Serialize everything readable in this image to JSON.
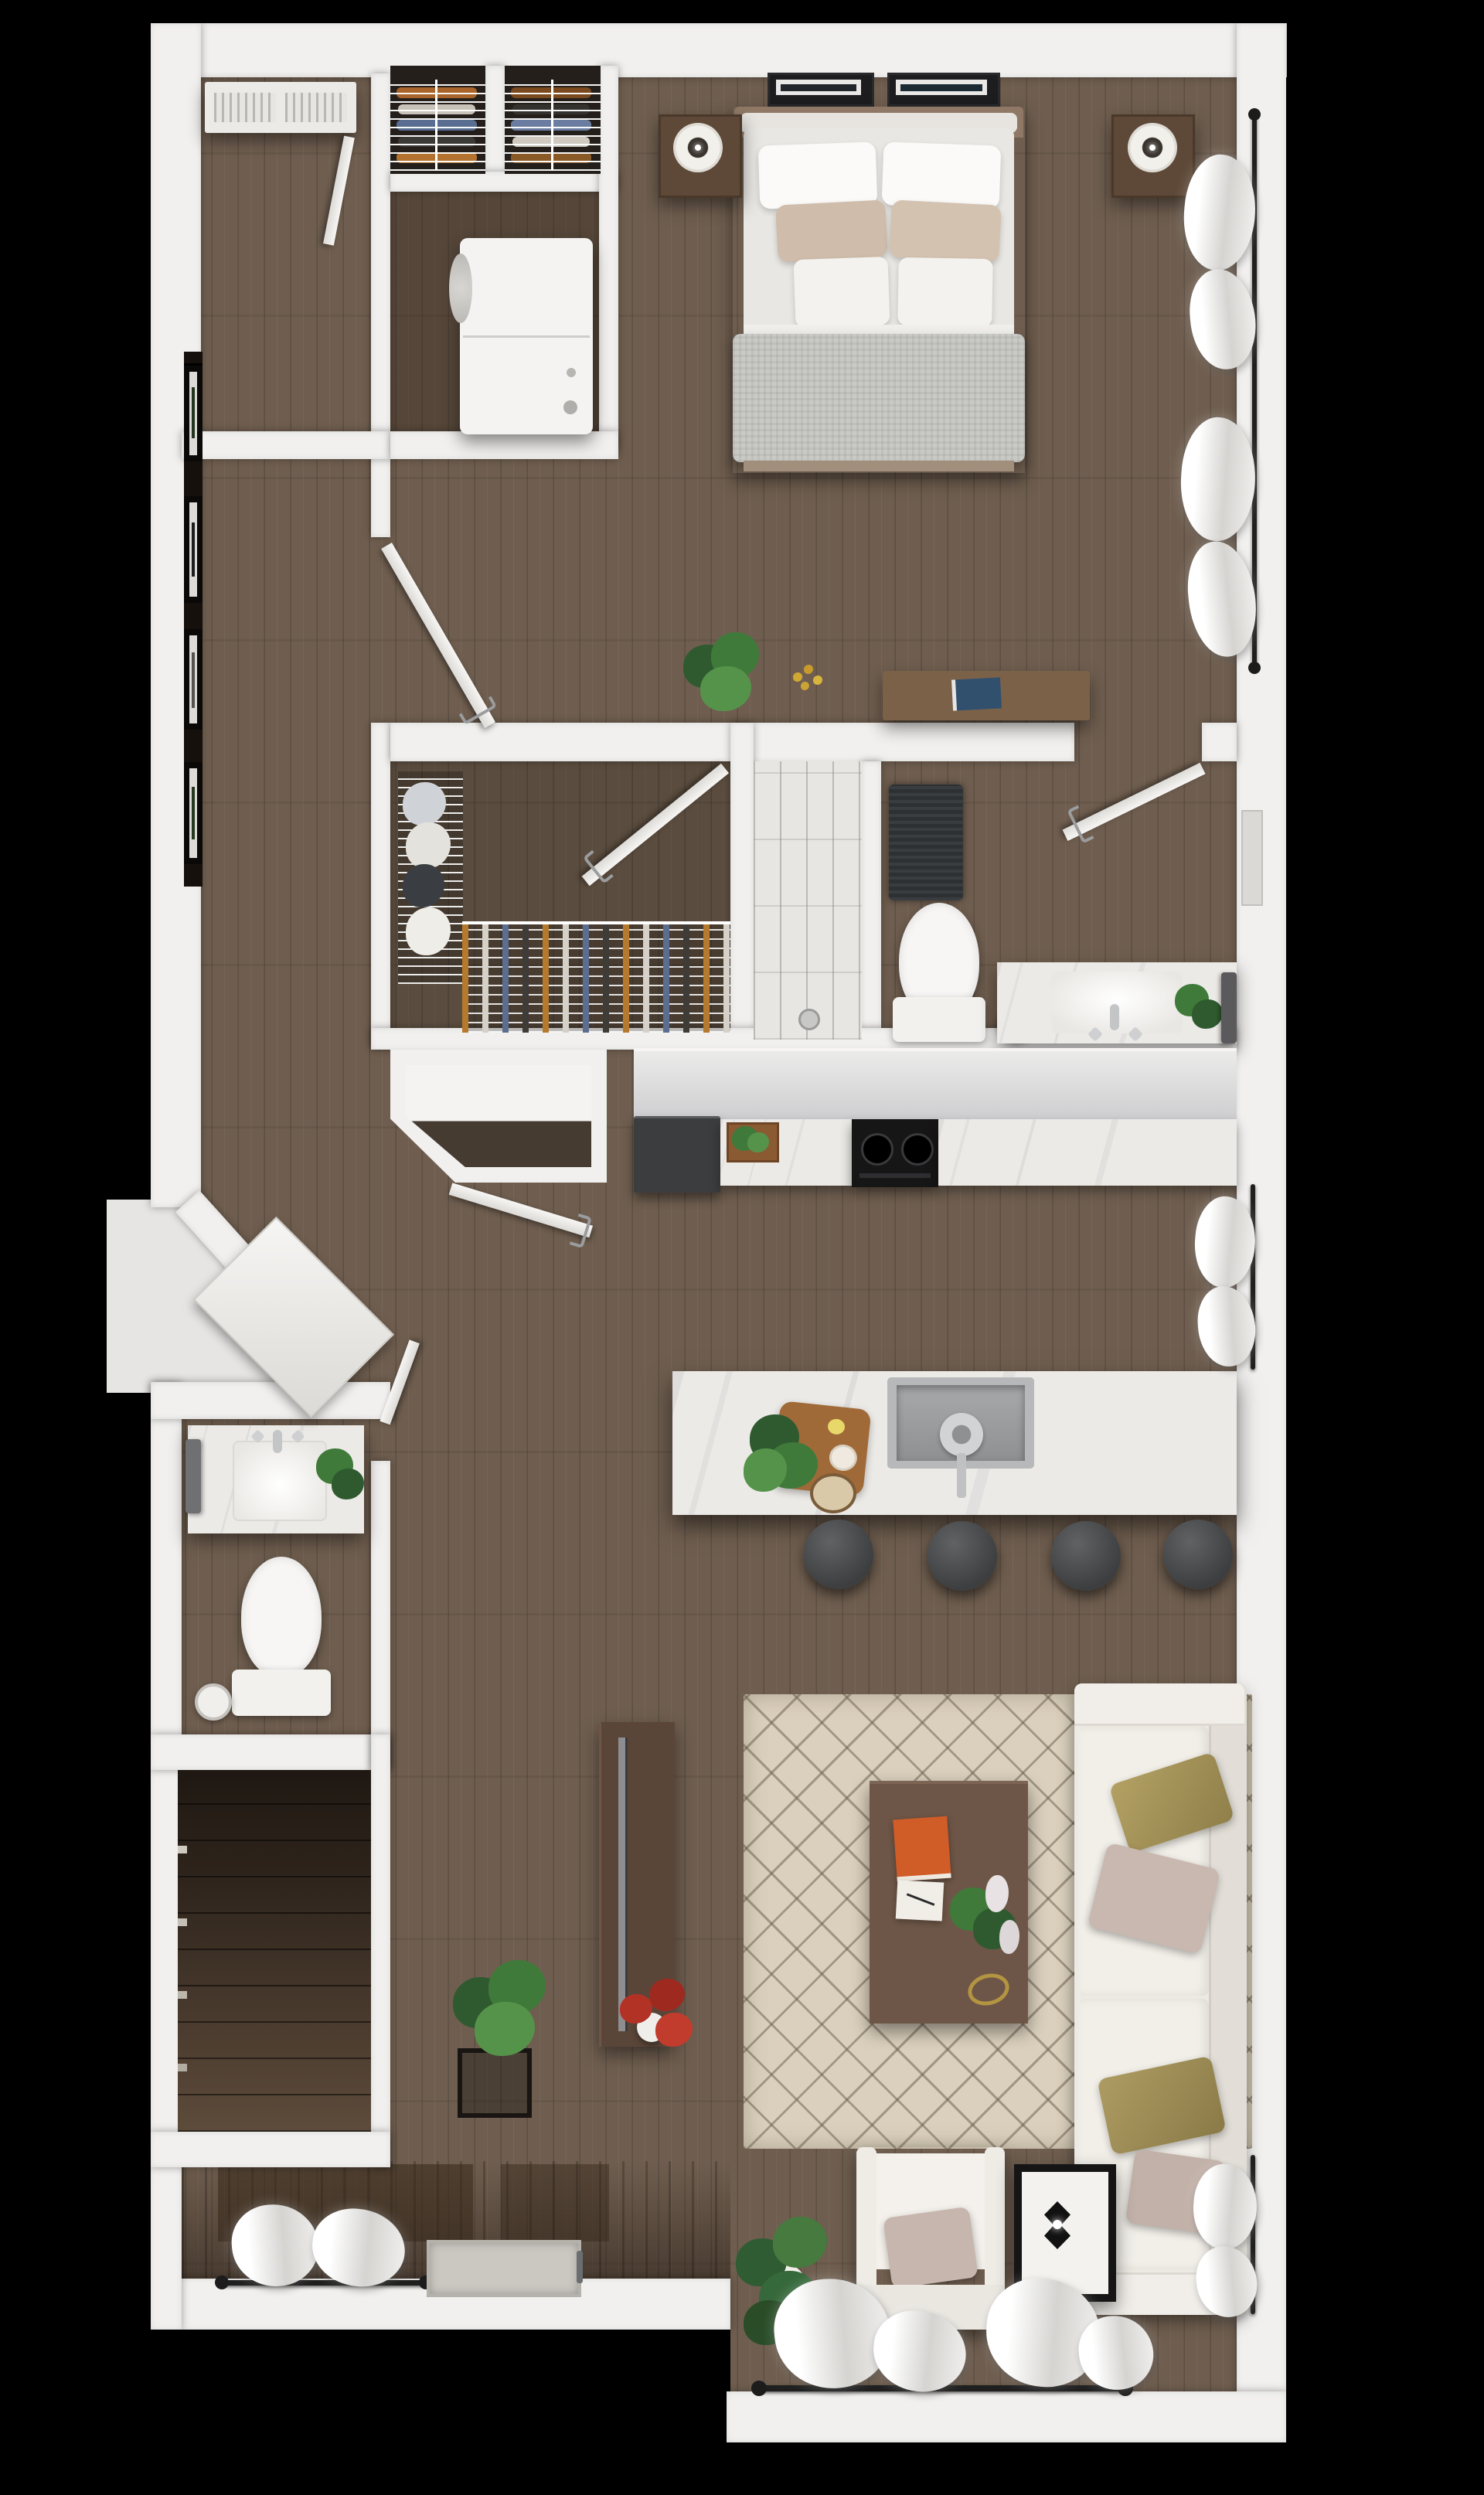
{
  "scene": {
    "description": "3D rendered top-down dollhouse floor plan of a one-bedroom apartment",
    "view": "top-down",
    "background_color": "#000000"
  },
  "rooms": {
    "bedroom": {
      "name": "Bedroom",
      "furniture": [
        "king bed with white bedding",
        "two white sleeping pillows",
        "two beige accent pillows",
        "two white front pillows",
        "gray knit throw blanket",
        "left nightstand",
        "right nightstand",
        "round table lamp left",
        "round table lamp right",
        "framed artwork pair above headboard",
        "wood media bench",
        "blue book",
        "green potted plant",
        "yellow flowers",
        "window with sheer curtains"
      ]
    },
    "closet_a": {
      "name": "Closet",
      "furniture": [
        "wire shelving",
        "folded clothes"
      ]
    },
    "closet_b": {
      "name": "Closet",
      "furniture": [
        "wire shelving",
        "folded clothes"
      ]
    },
    "laundry": {
      "name": "Laundry Closet",
      "furniture": [
        "stacked washer and dryer"
      ]
    },
    "utility": {
      "name": "Utility Room",
      "furniture": [
        "ceiling HVAC unit with louvers",
        "door"
      ]
    },
    "hallway": {
      "name": "Hallway",
      "furniture": [
        "gallery wall with four dark picture frames"
      ]
    },
    "walk_in_closet": {
      "name": "Walk-in Closet",
      "furniture": [
        "wire shelving with folded clothes",
        "hanging rod with clothes on hangers",
        "door"
      ]
    },
    "shower": {
      "name": "Shower",
      "furniture": [
        "marble subway tile",
        "drain"
      ]
    },
    "bathroom": {
      "name": "Bathroom",
      "furniture": [
        "dark gray bath mat",
        "toilet",
        "toilet paper roll",
        "marble vanity with sink",
        "faucet",
        "green plant",
        "dark gray towel",
        "wall mirror",
        "door"
      ]
    },
    "kitchen": {
      "name": "Kitchen",
      "furniture": [
        "graphite refrigerator",
        "marble countertop",
        "herb crate",
        "black gas cooktop with two burners",
        "marble island",
        "stainless steel sink",
        "faucet",
        "wood cutting board with herbs",
        "bowl of seeds",
        "four charcoal counter stools",
        "window with sheer curtain"
      ]
    },
    "entry": {
      "name": "Entry",
      "furniture": [
        "angled entry wall",
        "open entry door",
        "chamfered coat closet with open door",
        "door mat",
        "entry threshold handle",
        "window with sheer curtains",
        "plant on black stand"
      ]
    },
    "half_bathroom": {
      "name": "Half Bathroom",
      "furniture": [
        "marble vanity with white sink",
        "faucet",
        "green plant",
        "gray hand towel",
        "toilet",
        "toilet paper roll",
        "door"
      ]
    },
    "stairwell": {
      "name": "Stairwell",
      "furniture": [
        "descending wood staircase"
      ]
    },
    "living_room": {
      "name": "Living Room",
      "furniture": [
        "beige diamond-pattern area rug",
        "white sofa",
        "two olive pillows",
        "two taupe pillows",
        "white armchair with taupe pillow",
        "dark wood coffee table",
        "orange book",
        "white notepad with pen",
        "plant with white flowers",
        "gold decor ring",
        "wood media console",
        "flat TV on console",
        "red-flower plant in vase",
        "black metal side table with lamp",
        "monstera floor plant",
        "windows with sheer curtains and black rods"
      ]
    }
  },
  "colors": {
    "background": "#000000",
    "wall_white": "#F1F0EE",
    "floor_wood": "#6F5E4F",
    "stair_dark_wood": "#2E241C",
    "marble": "#ECEAE7",
    "tile_grout": "#828280",
    "rug_beige": "#DBD0BD",
    "rug_lattice": "#685C4A",
    "sofa_white": "#EDEAE4",
    "pillow_olive": "#AD9C62",
    "pillow_taupe": "#C9B8AF",
    "accent_pillow_beige": "#CFBCAB",
    "throw_gray": "#C9C9C6",
    "stool_charcoal": "#3C3E40",
    "stove_black": "#161617",
    "fridge_graphite": "#3C3D3F",
    "wood_furniture": "#6B5244",
    "book_orange": "#D05C28",
    "book_blue": "#31506E",
    "plant_green": "#3F7A3A",
    "flowers_red": "#B33226",
    "curtain_rod_black": "#1F1F1F"
  }
}
